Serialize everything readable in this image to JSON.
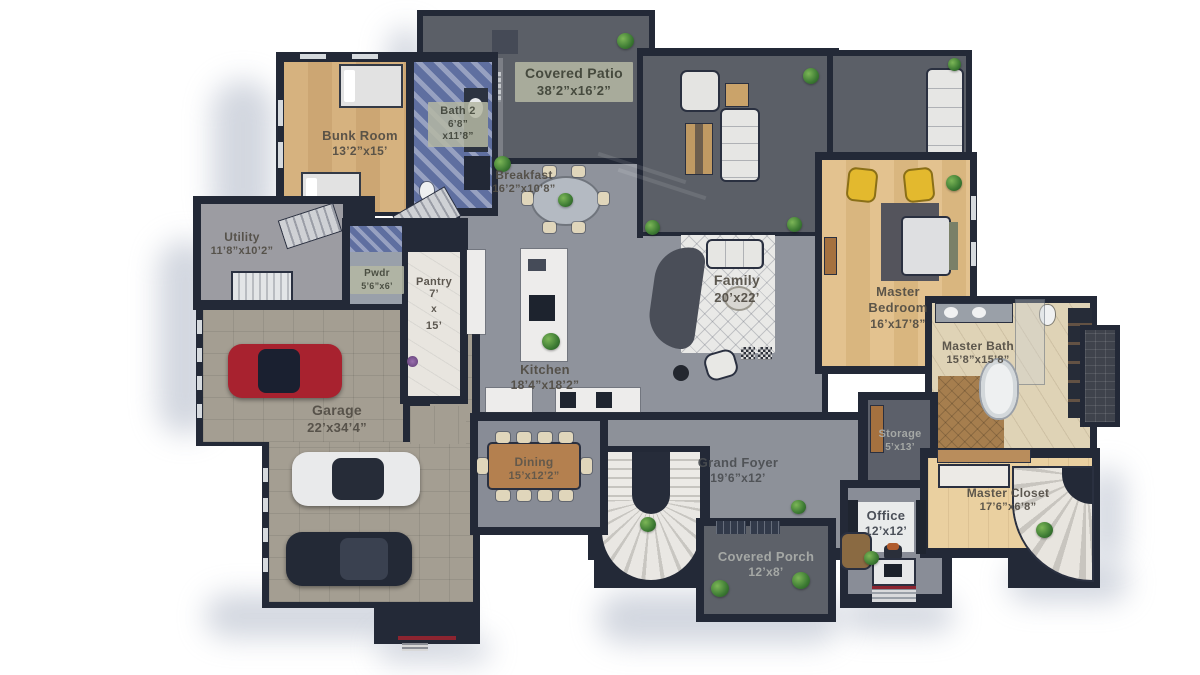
{
  "title": "First Floor Plan (3D overhead rendering)",
  "rooms": {
    "covered_patio": {
      "name": "Covered Patio",
      "dims": "38’2”x16’2”"
    },
    "bunk_room": {
      "name": "Bunk Room",
      "dims": "13’2”x15’"
    },
    "bath_2": {
      "name": "Bath 2",
      "dims_a": "6’8”",
      "dims_b": "x11’8”"
    },
    "breakfast": {
      "name": "Breakfast",
      "dims": "16’2”x10’8”"
    },
    "utility": {
      "name": "Utility",
      "dims": "11’8”x10’2”"
    },
    "pwdr": {
      "name": "Pwdr",
      "dims": "5’6”x6’"
    },
    "pantry": {
      "name": "Pantry",
      "dims_a": "7’",
      "dims_b": "x",
      "dims_c": "15’"
    },
    "kitchen": {
      "name": "Kitchen",
      "dims": "18’4”x18’2”"
    },
    "family": {
      "name": "Family",
      "dims": "20’x22’"
    },
    "master_bedroom": {
      "name": "Master Bedroom",
      "dims": "16’x17’8”"
    },
    "master_bath": {
      "name": "Master Bath",
      "dims": "15’8”x15’8”"
    },
    "garage": {
      "name": "Garage",
      "dims": "22’x34’4”"
    },
    "dining": {
      "name": "Dining",
      "dims": "15’x12’2”"
    },
    "grand_foyer": {
      "name": "Grand Foyer",
      "dims": "19’6”x12’"
    },
    "covered_porch": {
      "name": "Covered Porch",
      "dims": "12’x8’"
    },
    "office": {
      "name": "Office",
      "dims": "12’x12’"
    },
    "storage": {
      "name": "Storage",
      "dims": "5’x13’"
    },
    "master_closet": {
      "name": "Master Closet",
      "dims": "17’6”x6’8”"
    }
  },
  "palette": {
    "wall": "#232937",
    "concrete_floor": "#8f939c",
    "patio_floor": "#5c6069",
    "wood_floor": "#e0c08c",
    "blue_tile": "#5f6fa0",
    "cream_floor": "#ead0a0",
    "label_text": "#514c44",
    "badge_bg": "#b5b8a4",
    "car_red": "#a8222f",
    "car_white": "#e9eaeb",
    "car_dark": "#232936",
    "accent_chair_yellow": "#e3b92e"
  }
}
